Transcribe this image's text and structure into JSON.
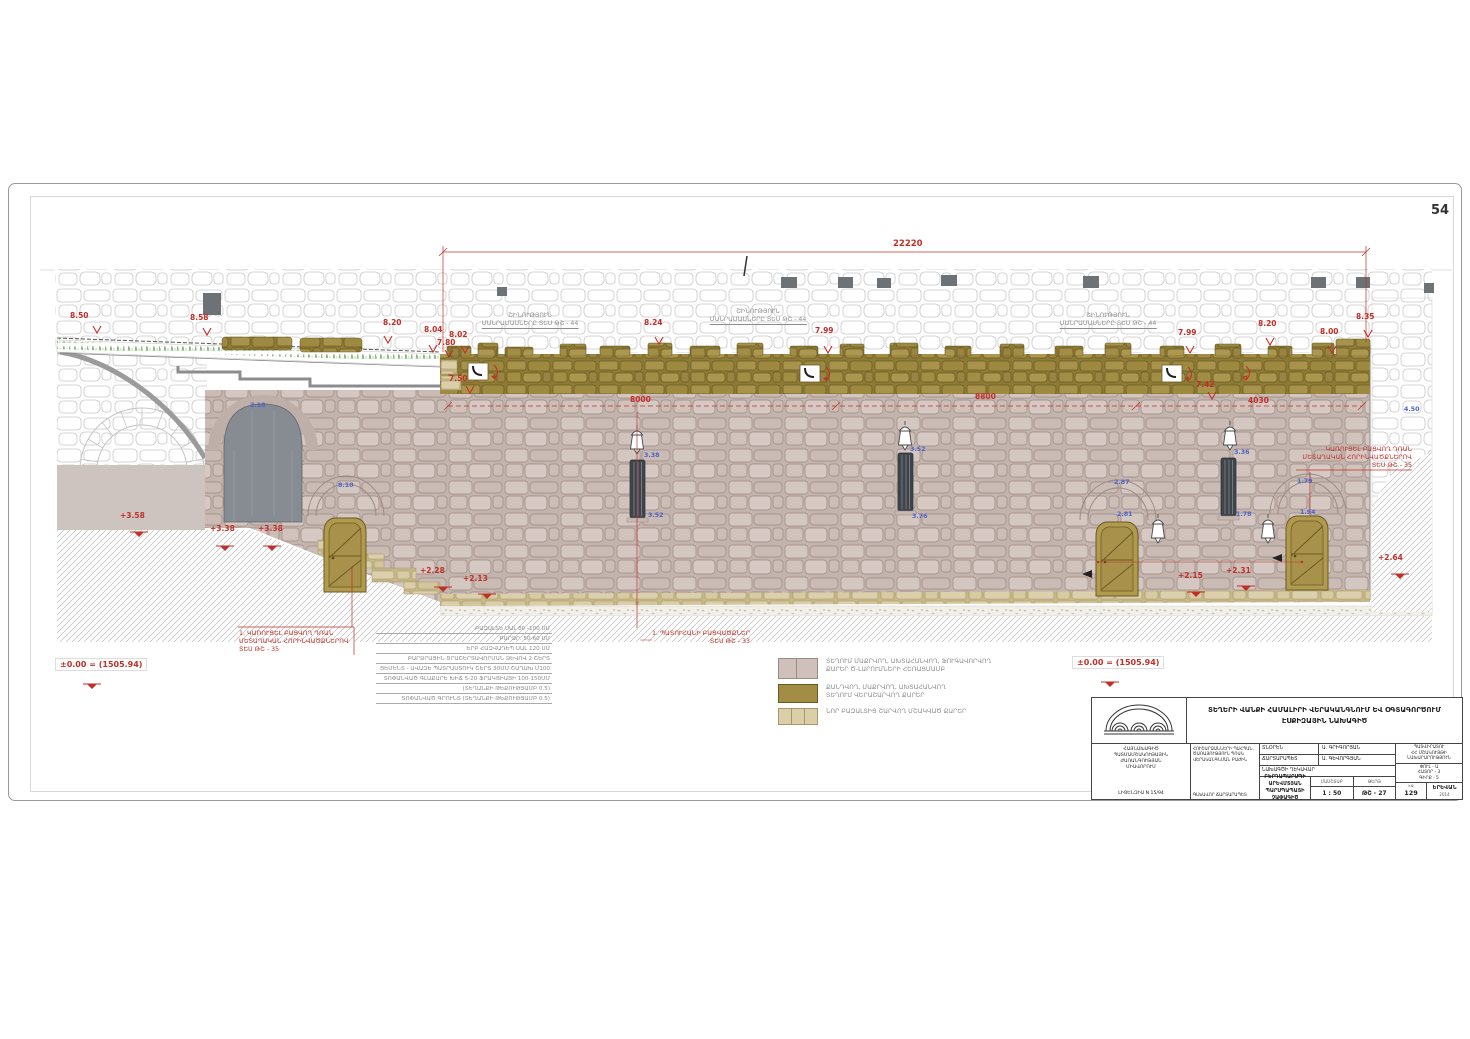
{
  "sheet": {
    "page_number": "54"
  },
  "dims": {
    "red": [
      "8.50",
      "8.58",
      "8.20",
      "8.04",
      "8.02",
      "7.80",
      "7.50",
      "8.24",
      "7.99",
      "7.99",
      "8.20",
      "8.00",
      "8.35",
      "7.42",
      "8000",
      "8800",
      "4030",
      "22220",
      "+3.58",
      "+3.38",
      "+3.38",
      "+2.28",
      "+2.13",
      "+2.15",
      "+2.31",
      "+2.64"
    ],
    "datum_left": "±0.00 = (1505.94)",
    "datum_right": "±0.00 = (1505.94)",
    "blue": [
      "3.38",
      "3.52",
      "3.52",
      "3.76",
      "3.36",
      "1.78",
      "2.87",
      "2.81",
      "1.79",
      "1.94",
      "8.10",
      "4.50",
      "3.18"
    ]
  },
  "top_labels": [
    {
      "l1": "ՇԻՆՈՒԹՅՈՒՆ",
      "l2": "ՄԱՆՐԱՄԱՍՆԵՐԸ ՏԵՍ ԹՇ - 44"
    },
    {
      "l1": "ՇԻՆՈՒԹՅՈՒՆ",
      "l2": "ՄԱՆՐԱՄԱՍՆԵՐԸ ՏԵՍ ԹՇ - 44"
    },
    {
      "l1": "ՇԻՆՈՒԹՅՈՒՆ",
      "l2": "ՄԱՆՐԱՄԱՍՆԵՐԸ ՏԵՍ ԹՇ - 44"
    }
  ],
  "notes": {
    "left": [
      "1. ԿԱՌՈՒՑԵԼ ԲԱՑՎՈՂ ԴՌԱՆ",
      "ՄԵՏԱՂԱԿԱՆ ՀՈՐԻՆՎԱԾՔՆԵՐՈՎ",
      "ՏԵՍ ԹՇ - 35"
    ],
    "window": [
      "1. ՊԱՏՈՒՀԱՆԻ ԲԱՑՎԱԾՔՆԵՐ",
      "ՏԵՍ ԹՇ - 33"
    ],
    "right": [
      "ԿԱՌՈՒՑԵԼ ԲԱՑՎՈՂ ԴՌԱՆ",
      "ՄԵՏԱՂԱԿԱՆ ՀՈՐԻՆՎԱԾՔՆԵՐՈՎ",
      "ՏԵՍ ԹՇ - 35"
    ]
  },
  "spec_lines": [
    "ԲԱԶԱԼՏԵ ՍԱԼ 80 -100 ՍՄ",
    "ԲԱՐՁՐ. 50-60 ՍՄ",
    "ԵՐԲ ՀԱԶՎԱԴԵՊ ՍԱԼ 120 ՍՄ",
    "ԲԱՐՁՐԱՅԻՆ ՑՐԱՇԵՐՏԱՎՈՐՄԱՆ ՁԵՎՈՎ 2 ՇԵՐՏ",
    "ՑԵՄԵՆՏ - ԱՎԱԶԵ ՊԱՏՐԱՍՏՈՒԿ ՇԵՐՏ 30ՄՄ ՇԱՂԱԽ Մ100",
    "ՏՈՓԱՆՎԱԾ ԳԼԱՔԱՐԵ ԽԻՃ 5-20 ՖՐԱԿՑԻԱՅԻ 100-150ՄՄ",
    "(ՏԵՂԱՆՔԻ ԹԵՔՈՒԹՅԱՄԲ 0.5)",
    "ՏՈՓԱՆՎԱԾ ԳՐՈՒՆՏ (ՏԵՂԱՆՔԻ ԹԵՔՈՒԹՅԱՄԲ 0.5)"
  ],
  "legend": {
    "items": [
      {
        "line1": "ՏԵՂՈՒՄ ՄԱՔՐՎՈՂ, ԱԽՏԱՀԱՆՎՈՂ, ՖՈՒԳԱՎՈՐՎՈՂ",
        "line2": "ՔԱՐԵՐ Ծ-ԼԱՐՈՒՄՆԵՐԻ ՀԵՌԱՑՄԱՄԲ",
        "color": "#cfc0ba"
      },
      {
        "line1": "ՔԱՆԴՎՈՂ, ՄԱՔՐՎՈՂ, ԱԽՏԱՀԱՆՎՈՂ",
        "line2": "ՏԵՂՈՒՄ ՎԵՐԱՇԱՐՎՈՂ ՔԱՐԵՐ",
        "color": "#a28d45"
      },
      {
        "line1": "ՆՈՐ ԲԱԶԱԼՏԻՑ ՇԱՐՎՈՂ ՄՇԱԿՎԱԾ ՔԱՐԵՐ",
        "line2": "",
        "color": "#dbcfa9"
      }
    ]
  },
  "title_block": {
    "title1": "ՏԵՂԵՐԻ ՎԱՆՔԻ ՀԱՄԱԼԻՐԻ ՎԵՐԱԿԱՆԳՆՈՒՄ ԵՎ ՕԳՏԱԳՈՐԾՈՒՄ",
    "title2": "ԷՍՔԻԶԱՅԻՆ ՆԱԽԱԳԻԾ",
    "org1": "ՀԱՅՆԱԽԱԳԻԾ",
    "org2": "ՊԱՏՄԱՄՇԱԿՈՒԹԱՅԻՆ ԺԱՌԱՆԳՈՒԹՅԱՆ",
    "org3": "ՄԻԱՎՈՐՈՒՄ",
    "license": "ԼԻՑԵՆԶԻԱ N 15/94",
    "dept1": "ՀՈՒՇԱՐՁԱՆՆԵՐԻ ՊԱՀՊԱՆ.",
    "dept2": "ԾԱՌԱՅՈՒԹՅՈՒՆ ՊՈԱԿ",
    "dept3": "ՎԵՐԱԿԱՆԳՆՄԱՆ ԲԱԺԻՆ",
    "chief": "ԳԼԽԱՎՈՐ ՃԱՐՏԱՐԱՊԵՏ",
    "row1_label": "ՏՆՕՐԵՆ",
    "row1_name": "Ա. ԳՐԻԳՈՐՅԱՆ",
    "row2_label": "ՃԱՐՏԱՐԱՊԵՏ",
    "row2_name": "Ա. ԳԵՎՈՐԳՅԱՆ",
    "row3_label": "ՆԱԽԱԳԾԻ ՂԵԿԱՎԱՐ",
    "drawing1": "ԲԵՐԴԱՊԱՐՍՊԻ ԱՐԵՎՄՏՅԱՆ",
    "drawing2": "ՊԱՐՍՊԱՊԱՏԻ ՉԱՓԱԳԻԾ",
    "scale_label": "ՄԱՍՇՏԱԲ",
    "scale": "1 : 50",
    "sheet_label": "ԹԵՐԹ",
    "sheet": "ԹՇ - 27",
    "client_label": "ՊԱՏՎԻՐԱՏՈՒ",
    "client1": "ՀՀ ՄՇԱԿՈՒՅԹԻ",
    "client2": "ՆԱԽԱՐԱՐՈՒԹՅՈՒՆ",
    "stage": "ՓՈՒԼ - Ա",
    "volume": "ՀԱՏՈՐ - 3",
    "book": "ԳԻՐՔ - 5",
    "page_label": "ԷՋ",
    "page": "129",
    "city": "ԵՐԵՎԱՆ",
    "year": "2014"
  }
}
